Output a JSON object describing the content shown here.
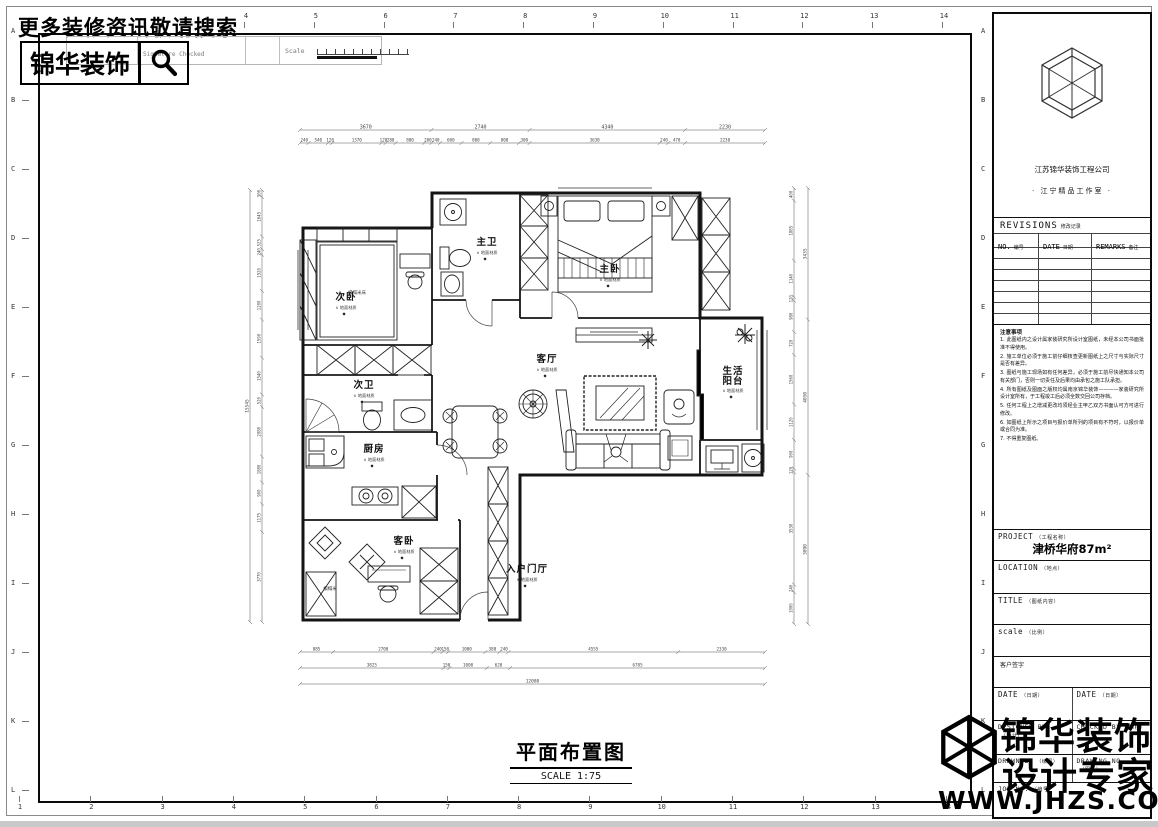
{
  "header": {
    "search_text": "更多装修资讯敬请搜索",
    "brand": "锦华装饰",
    "strip": {
      "signature": "Signature Checked",
      "scale_label": "Scale"
    }
  },
  "grid": {
    "cols": [
      "1",
      "2",
      "3",
      "4",
      "5",
      "6",
      "7",
      "8",
      "9",
      "10",
      "11",
      "12",
      "13",
      "14"
    ],
    "rows": [
      "A",
      "B",
      "C",
      "D",
      "E",
      "F",
      "G",
      "H",
      "I",
      "J",
      "K",
      "L"
    ]
  },
  "plan": {
    "title": "平面布置图",
    "scale": "SCALE  1:75",
    "note_prefix": "∧",
    "marker": "◆",
    "rooms": [
      {
        "name": "主卫",
        "note": "地面材质",
        "x": 487,
        "y": 245
      },
      {
        "name": "主卧",
        "note": "地面材质",
        "x": 610,
        "y": 272
      },
      {
        "name": "次卧",
        "note": "地面材质",
        "x": 346,
        "y": 300
      },
      {
        "name": "次卫",
        "note": "地面材质",
        "x": 364,
        "y": 388
      },
      {
        "name": "厨房",
        "note": "地面材质",
        "x": 374,
        "y": 452
      },
      {
        "name": "客厅",
        "note": "地面材质",
        "x": 547,
        "y": 362
      },
      {
        "name": "生活阳台",
        "note": "地面材质",
        "x": 733,
        "y": 374,
        "two_line": true
      },
      {
        "name": "客卧",
        "note": "地面材质",
        "x": 404,
        "y": 544
      },
      {
        "name": "入户门厅",
        "note": "地面材质",
        "x": 527,
        "y": 572
      }
    ],
    "micro_labels": [
      {
        "text": "榻榻米床",
        "x": 357,
        "y": 294
      },
      {
        "text": "榻榻米",
        "x": 330,
        "y": 590
      }
    ],
    "dims": {
      "chains": [
        {
          "id": "top-main",
          "dir": "h",
          "pos": 130,
          "from": 300,
          "to": 765,
          "fs": 5,
          "vals": [
            3670,
            2740,
            4340,
            2230
          ]
        },
        {
          "id": "top-sub",
          "dir": "h",
          "pos": 143,
          "from": 300,
          "to": 765,
          "fs": 4.2,
          "vals": [
            240,
            540,
            120,
            1370,
            120,
            280,
            800,
            200,
            240,
            600,
            800,
            800,
            300,
            3630,
            240,
            470,
            2230
          ]
        },
        {
          "id": "bottom-1",
          "dir": "h",
          "pos": 652,
          "from": 300,
          "to": 765,
          "fs": 4.2,
          "vals": [
            885,
            2700,
            240,
            150,
            1000,
            380,
            240,
            4555,
            2330
          ]
        },
        {
          "id": "bottom-2",
          "dir": "h",
          "pos": 668,
          "from": 300,
          "to": 765,
          "fs": 4.2,
          "vals": [
            3825,
            150,
            1000,
            620,
            6785
          ]
        },
        {
          "id": "bottom-3",
          "dir": "h",
          "pos": 684,
          "from": 300,
          "to": 765,
          "fs": 4.5,
          "vals": [
            12080
          ]
        },
        {
          "id": "left-main",
          "dir": "v",
          "pos": 250,
          "from": 190,
          "to": 622,
          "fs": 4.5,
          "vals": [
            15545
          ]
        },
        {
          "id": "left-sub",
          "dir": "v",
          "pos": 262,
          "from": 190,
          "to": 622,
          "fs": 4,
          "vals": [
            300,
            1645,
            525,
            240,
            1520,
            1200,
            1590,
            1540,
            520,
            2080,
            1080,
            900,
            1175,
            3770
          ]
        },
        {
          "id": "right-sub",
          "dir": "v",
          "pos": 794,
          "from": 188,
          "to": 624,
          "fs": 4,
          "vals": [
            400,
            1885,
            1140,
            120,
            980,
            720,
            1560,
            1120,
            900,
            120,
            3530,
            240,
            1000
          ]
        },
        {
          "id": "right-main",
          "dir": "v",
          "pos": 808,
          "from": 188,
          "to": 624,
          "fs": 4.5,
          "vals": [
            3435,
            4050,
            3890
          ]
        }
      ]
    }
  },
  "title_block": {
    "company": "江苏锦华装饰工程公司",
    "studio": "· 江宁精品工作室 ·",
    "revisions": {
      "title": "REVISIONS",
      "title_cn": "修改记录",
      "cols": [
        {
          "en": "NO.",
          "cn": "编号"
        },
        {
          "en": "DATE",
          "cn": "日期"
        },
        {
          "en": "REMARKS",
          "cn": "备注"
        }
      ],
      "empty_rows": 7
    },
    "notes_title": "注意事项",
    "notes": [
      "1. 此图纸内之设计属家装研究所设计室图纸，未经本公司书面批准不得使用。",
      "2. 施工单位必须于施工前仔细核查更新图纸上之尺寸与实际尺寸是否有差异。",
      "3. 图纸与施工现场如有任何差异，必须于施工前尽快通知本公司有关部门，否则一切责任及后果均由承包之施工队承担。",
      "4. 所有图纸及图面之版权均属南京锦华装饰————家装研究所设计室所有，于工程竣工后必须全数交回公司存档。",
      "5. 任何工程上之增减更改均须经业主甲乙双方书面认可方可进行修改。",
      "6. 如图纸上所示之项目与报价单所列的项目有不符时，以报价单或合同为准。",
      "7. 不得重复图纸。"
    ],
    "project": {
      "label": "PROJECT",
      "label_cn": "（工程名称）",
      "value": "津桥华府87m²"
    },
    "location": {
      "label": "LOCATION",
      "label_cn": "（地点）",
      "value": ""
    },
    "sheet_title": {
      "label": "TITLE",
      "label_cn": "（图纸内容）",
      "value": ""
    },
    "scale_row": {
      "label": "scale",
      "label_cn": "（比例）",
      "value": ""
    },
    "client_sign": "客户签字",
    "date_left": {
      "label": "DATE",
      "label_cn": "（日期）"
    },
    "date_right": {
      "label": "DATE",
      "label_cn": "（日期）"
    },
    "designed_by": {
      "label": "DESIGNED BY",
      "label_cn": "（设计）"
    },
    "checked_by": {
      "label": "CHECKED BY",
      "label_cn": "（审核）"
    },
    "drawn_by": {
      "label": "DRAWN BY",
      "label_cn": "（绘图）"
    },
    "drawing_no": {
      "label": "DRAWING NO.",
      "label_cn": "（图号）"
    },
    "job_no": {
      "label": "JOB NO.",
      "label_cn": "（编号）"
    }
  },
  "watermark": {
    "line1": "锦华装饰",
    "line2": "设计专家",
    "url": "WWW.JHZS.COM"
  }
}
